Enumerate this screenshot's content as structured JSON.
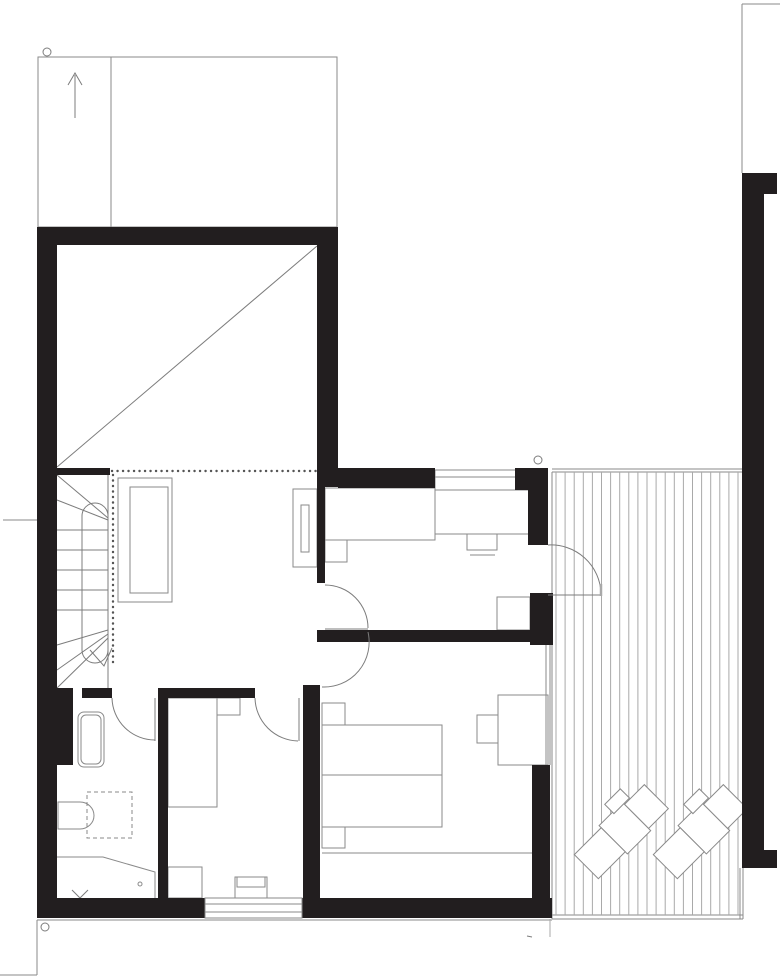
{
  "title": "upper-floor-plan",
  "palette": {
    "wall": "#221e1f",
    "line": "#8a8a8a",
    "mid": "#7c7c7c",
    "light": "#a9a9a9",
    "bg": "#ffffff"
  },
  "plan": {
    "width": 780,
    "height": 979,
    "shapes": [
      {
        "t": "rect",
        "name": "carport-outline",
        "x": 38,
        "y": 57,
        "w": 299,
        "h": 170,
        "c": "line"
      },
      {
        "t": "line",
        "name": "carport-divider",
        "x1": 111,
        "y1": 57,
        "x2": 111,
        "y2": 227,
        "c": "line"
      },
      {
        "t": "line",
        "name": "entry-arrow-shaft",
        "x1": 75,
        "y1": 118,
        "x2": 75,
        "y2": 75,
        "c": "mid"
      },
      {
        "t": "poly",
        "name": "entry-arrow-head",
        "pts": "68,85 75,73 82,85",
        "c": "mid"
      },
      {
        "t": "line",
        "name": "site-line-top-right-h",
        "x1": 742,
        "y1": 4,
        "x2": 780,
        "y2": 4,
        "c": "line"
      },
      {
        "t": "line",
        "name": "site-line-top-right-v",
        "x1": 742,
        "y1": 4,
        "x2": 742,
        "y2": 173,
        "c": "line"
      },
      {
        "t": "line",
        "name": "section-tick-left",
        "x1": 3,
        "y1": 520,
        "x2": 37,
        "y2": 520,
        "c": "line"
      },
      {
        "t": "line",
        "name": "ground-line-bottom",
        "x1": 37,
        "y1": 920,
        "x2": 552,
        "y2": 920,
        "c": "line"
      },
      {
        "t": "line",
        "name": "terrain-line-v",
        "x1": 37,
        "y1": 920,
        "x2": 37,
        "y2": 975,
        "c": "line"
      },
      {
        "t": "line",
        "name": "terrain-line-h",
        "x1": 0,
        "y1": 975,
        "x2": 37,
        "y2": 975,
        "c": "line"
      },
      {
        "t": "line",
        "name": "terrain-line-under-deck",
        "x1": 550,
        "y1": 919,
        "x2": 550,
        "y2": 937,
        "c": "light"
      },
      {
        "t": "line",
        "name": "tiny-mark",
        "x1": 527,
        "y1": 936,
        "x2": 532,
        "y2": 937,
        "c": "mid"
      },
      {
        "t": "line",
        "name": "deck-edge-top-1",
        "x1": 552,
        "y1": 469,
        "x2": 742,
        "y2": 469,
        "c": "line"
      },
      {
        "t": "line",
        "name": "deck-edge-top-2",
        "x1": 552,
        "y1": 472,
        "x2": 742,
        "y2": 472,
        "c": "line"
      },
      {
        "t": "line",
        "name": "deck-edge-left",
        "x1": 552,
        "y1": 472,
        "x2": 552,
        "y2": 919,
        "c": "line"
      },
      {
        "t": "line",
        "name": "deck-edge-bottom-1",
        "x1": 552,
        "y1": 915,
        "x2": 743,
        "y2": 915,
        "c": "line"
      },
      {
        "t": "line",
        "name": "deck-edge-bottom-2",
        "x1": 552,
        "y1": 919,
        "x2": 743,
        "y2": 919,
        "c": "line"
      },
      {
        "t": "line",
        "name": "deck-edge-right-1",
        "x1": 740,
        "y1": 868,
        "x2": 740,
        "y2": 919,
        "c": "line"
      },
      {
        "t": "line",
        "name": "deck-edge-right-2",
        "x1": 743,
        "y1": 868,
        "x2": 743,
        "y2": 919,
        "c": "line"
      },
      {
        "t": "vlines",
        "name": "deck-boards",
        "from": 556,
        "to": 738,
        "step": 9.1,
        "y1": 472,
        "y2": 915,
        "c": "light"
      },
      {
        "t": "group",
        "name": "sun-lounger-1",
        "tx": 621,
        "ty": 832,
        "rot": 45,
        "shapes": [
          {
            "t": "rect",
            "name": "lounger-head",
            "x": -17,
            "y": -50,
            "w": 34,
            "h": 28,
            "c": "line",
            "f": "#ffffff"
          },
          {
            "t": "rect",
            "name": "lounger-seat",
            "x": -20,
            "y": -22,
            "w": 40,
            "h": 33,
            "c": "line",
            "f": "#ffffff"
          },
          {
            "t": "rect",
            "name": "lounger-foot",
            "x": -17,
            "y": 11,
            "w": 34,
            "h": 38,
            "c": "line",
            "f": "#ffffff"
          },
          {
            "t": "rect",
            "name": "lounger-side-table",
            "x": -31,
            "y": -30,
            "w": 13,
            "h": 22,
            "c": "line",
            "f": "#ffffff"
          }
        ]
      },
      {
        "t": "group",
        "name": "sun-lounger-2",
        "tx": 700,
        "ty": 832,
        "rot": 45,
        "shapes": [
          {
            "t": "rect",
            "name": "lounger-head",
            "x": -17,
            "y": -50,
            "w": 34,
            "h": 28,
            "c": "line",
            "f": "#ffffff"
          },
          {
            "t": "rect",
            "name": "lounger-seat",
            "x": -20,
            "y": -22,
            "w": 40,
            "h": 33,
            "c": "line",
            "f": "#ffffff"
          },
          {
            "t": "rect",
            "name": "lounger-foot",
            "x": -17,
            "y": 11,
            "w": 34,
            "h": 38,
            "c": "line",
            "f": "#ffffff"
          },
          {
            "t": "rect",
            "name": "lounger-side-table",
            "x": -31,
            "y": -30,
            "w": 13,
            "h": 22,
            "c": "line",
            "f": "#ffffff"
          }
        ]
      },
      {
        "t": "line",
        "name": "void-diagonal",
        "x1": 57,
        "y1": 467,
        "x2": 317,
        "y2": 246,
        "c": "mid"
      },
      {
        "t": "rect",
        "name": "hall-sideboard-outer",
        "x": 118,
        "y": 478,
        "w": 54,
        "h": 124,
        "c": "line"
      },
      {
        "t": "rect",
        "name": "hall-sideboard-inner",
        "x": 130,
        "y": 487,
        "w": 38,
        "h": 106,
        "c": "line"
      },
      {
        "t": "rect",
        "name": "hall-cabinet",
        "x": 293,
        "y": 489,
        "w": 24,
        "h": 78,
        "c": "line"
      },
      {
        "t": "rect",
        "name": "hall-cabinet-inner",
        "x": 301,
        "y": 505,
        "w": 8,
        "h": 47,
        "c": "line"
      },
      {
        "t": "hlines",
        "name": "stair-treads",
        "ys": [
          530,
          550,
          570,
          590,
          610
        ],
        "x1": 57,
        "x2": 108,
        "c": "mid"
      },
      {
        "t": "line",
        "name": "stair-edge-right",
        "x1": 108,
        "y1": 475,
        "x2": 108,
        "y2": 688,
        "c": "mid"
      },
      {
        "t": "line",
        "name": "stair-winder-t1",
        "x1": 108,
        "y1": 518,
        "x2": 57,
        "y2": 475,
        "c": "mid"
      },
      {
        "t": "line",
        "name": "stair-winder-t2",
        "x1": 108,
        "y1": 520,
        "x2": 57,
        "y2": 500,
        "c": "mid"
      },
      {
        "t": "line",
        "name": "stair-winder-b1",
        "x1": 108,
        "y1": 630,
        "x2": 57,
        "y2": 645,
        "c": "mid"
      },
      {
        "t": "line",
        "name": "stair-winder-b2",
        "x1": 108,
        "y1": 634,
        "x2": 57,
        "y2": 670,
        "c": "mid"
      },
      {
        "t": "line",
        "name": "stair-winder-b3",
        "x1": 108,
        "y1": 638,
        "x2": 57,
        "y2": 688,
        "c": "mid"
      },
      {
        "t": "rect",
        "name": "stair-walkline",
        "x": 82,
        "y": 503,
        "w": 26,
        "h": 160,
        "rx": 13,
        "c": "mid"
      },
      {
        "t": "poly",
        "name": "stair-walkline-arrow",
        "pts": "90,650 104,666 112,648",
        "c": "mid"
      },
      {
        "t": "dot",
        "name": "balustrade-horizontal",
        "x1": 112,
        "y1": 471,
        "x2": 317,
        "y2": 471
      },
      {
        "t": "dot",
        "name": "balustrade-vertical",
        "x1": 113,
        "y1": 475,
        "x2": 113,
        "y2": 665
      },
      {
        "t": "rect",
        "name": "bedroom1-wardrobe",
        "x": 435,
        "y": 470,
        "w": 82,
        "h": 20,
        "c": "line"
      },
      {
        "t": "line",
        "name": "bedroom1-wardrobe-line",
        "x1": 435,
        "y1": 477,
        "x2": 517,
        "y2": 477,
        "c": "line"
      },
      {
        "t": "rect",
        "name": "bedroom1-bed",
        "x": 325,
        "y": 488,
        "w": 110,
        "h": 52,
        "c": "line"
      },
      {
        "t": "rect",
        "name": "bedroom1-nightstand",
        "x": 325,
        "y": 540,
        "w": 22,
        "h": 22,
        "c": "line"
      },
      {
        "t": "rect",
        "name": "bedroom1-desk",
        "x": 435,
        "y": 490,
        "w": 95,
        "h": 44,
        "c": "line"
      },
      {
        "t": "rect",
        "name": "bedroom1-chair",
        "x": 467,
        "y": 534,
        "w": 30,
        "h": 16,
        "c": "line"
      },
      {
        "t": "line",
        "name": "bedroom1-chair-front",
        "x1": 470,
        "y1": 555,
        "x2": 495,
        "y2": 555,
        "c": "line"
      },
      {
        "t": "rect",
        "name": "bedroom1-cabinet",
        "x": 497,
        "y": 597,
        "w": 33,
        "h": 33,
        "c": "line"
      },
      {
        "t": "rect",
        "name": "bedroom3-nightstand-a",
        "x": 322,
        "y": 703,
        "w": 23,
        "h": 22,
        "c": "line"
      },
      {
        "t": "rect",
        "name": "bedroom3-bed",
        "x": 322,
        "y": 725,
        "w": 120,
        "h": 102,
        "c": "line"
      },
      {
        "t": "line",
        "name": "bedroom3-bed-midline",
        "x1": 322,
        "y1": 775,
        "x2": 442,
        "y2": 775,
        "c": "line"
      },
      {
        "t": "rect",
        "name": "bedroom3-nightstand-b",
        "x": 322,
        "y": 827,
        "w": 23,
        "h": 21,
        "c": "line"
      },
      {
        "t": "line",
        "name": "bedroom3-bench-line",
        "x1": 322,
        "y1": 853,
        "x2": 533,
        "y2": 853,
        "c": "line"
      },
      {
        "t": "rect",
        "name": "bedroom3-desk",
        "x": 498,
        "y": 695,
        "w": 50,
        "h": 70,
        "c": "line"
      },
      {
        "t": "rect",
        "name": "bedroom3-chair",
        "x": 477,
        "y": 715,
        "w": 21,
        "h": 28,
        "c": "line"
      },
      {
        "t": "line",
        "name": "east-window-glazing-1",
        "x1": 546,
        "y1": 645,
        "x2": 546,
        "y2": 765,
        "c": "line"
      },
      {
        "t": "line",
        "name": "east-window-glazing-2",
        "x1": 550,
        "y1": 645,
        "x2": 550,
        "y2": 765,
        "c": "line"
      },
      {
        "t": "rect",
        "name": "bedroom2-bed",
        "x": 168,
        "y": 698,
        "w": 49,
        "h": 109,
        "c": "line"
      },
      {
        "t": "rect",
        "name": "bedroom2-nightstand",
        "x": 217,
        "y": 698,
        "w": 23,
        "h": 17,
        "c": "line"
      },
      {
        "t": "rect",
        "name": "bedroom2-dresser-a",
        "x": 168,
        "y": 867,
        "w": 34,
        "h": 31,
        "c": "line"
      },
      {
        "t": "rect",
        "name": "bedroom2-dresser-b",
        "x": 235,
        "y": 877,
        "w": 32,
        "h": 21,
        "c": "line"
      },
      {
        "t": "rect",
        "name": "bedroom2-dresser-b-inner",
        "x": 237,
        "y": 877,
        "w": 28,
        "h": 10,
        "c": "line"
      },
      {
        "t": "rect",
        "name": "bathtub-outer",
        "x": 78,
        "y": 712,
        "w": 26,
        "h": 55,
        "rx": 6,
        "c": "line"
      },
      {
        "t": "rect",
        "name": "bathtub-inner",
        "x": 81,
        "y": 715,
        "w": 20,
        "h": 49,
        "rx": 5,
        "c": "line"
      },
      {
        "t": "path",
        "name": "toilet",
        "d": "M80 802 L58 802 L58 829 L80 829 A14 13.5 0 0 0 80 802 Z",
        "c": "line",
        "f": "#ffffff"
      },
      {
        "t": "rect",
        "name": "shower-dashed",
        "x": 87,
        "y": 792,
        "w": 45,
        "h": 46,
        "c": "line",
        "dash": "4 3"
      },
      {
        "t": "poly",
        "name": "vanity-counter",
        "pts": "57,857 103,857 155,872 155,898",
        "c": "line"
      },
      {
        "t": "poly",
        "name": "vanity-check-mark",
        "pts": "72,890 80,898 88,890",
        "c": "mid"
      },
      {
        "t": "circle",
        "name": "drain-dot",
        "cx": 140,
        "cy": 884,
        "r": 2,
        "c": "line"
      },
      {
        "t": "wall",
        "name": "wall-void-top",
        "x": 37,
        "y": 227,
        "w": 301,
        "h": 18
      },
      {
        "t": "wall",
        "name": "wall-exterior-left",
        "x": 37,
        "y": 227,
        "w": 20,
        "h": 691
      },
      {
        "t": "wall",
        "name": "wall-void-right",
        "x": 317,
        "y": 227,
        "w": 21,
        "h": 260
      },
      {
        "t": "wall",
        "name": "wall-void-south-stub",
        "x": 55,
        "y": 468,
        "w": 55,
        "h": 7
      },
      {
        "t": "wall",
        "name": "wall-bedroom1-top",
        "x": 338,
        "y": 468,
        "w": 97,
        "h": 20
      },
      {
        "t": "wall",
        "name": "wall-pier-top-a",
        "x": 515,
        "y": 468,
        "w": 33,
        "h": 22
      },
      {
        "t": "wall",
        "name": "wall-pier-top-b",
        "x": 528,
        "y": 490,
        "w": 20,
        "h": 55
      },
      {
        "t": "wall",
        "name": "wall-hall-thin",
        "x": 317,
        "y": 487,
        "w": 8,
        "h": 96
      },
      {
        "t": "wall",
        "name": "wall-mid-horizontal",
        "x": 317,
        "y": 630,
        "w": 213,
        "h": 12
      },
      {
        "t": "wall",
        "name": "wall-pier-mid",
        "x": 530,
        "y": 593,
        "w": 23,
        "h": 52
      },
      {
        "t": "wall",
        "name": "wall-exterior-right-bottom",
        "x": 532,
        "y": 765,
        "w": 18,
        "h": 153
      },
      {
        "t": "wall",
        "name": "wall-bottom-a",
        "x": 37,
        "y": 898,
        "w": 168,
        "h": 20
      },
      {
        "t": "wall",
        "name": "wall-bottom-b",
        "x": 302,
        "y": 898,
        "w": 250,
        "h": 20
      },
      {
        "t": "wall",
        "name": "wall-center-vertical",
        "x": 303,
        "y": 685,
        "w": 17,
        "h": 213
      },
      {
        "t": "wall",
        "name": "wall-bath-bed2",
        "x": 158,
        "y": 688,
        "w": 10,
        "h": 210
      },
      {
        "t": "wall",
        "name": "wall-bath-top-seg",
        "x": 82,
        "y": 688,
        "w": 30,
        "h": 10
      },
      {
        "t": "wall",
        "name": "wall-bath-stub",
        "x": 55,
        "y": 688,
        "w": 18,
        "h": 77
      },
      {
        "t": "wall",
        "name": "wall-bedroom2-top",
        "x": 168,
        "y": 688,
        "w": 87,
        "h": 10
      },
      {
        "t": "wall",
        "name": "wall-ne-flange",
        "x": 742,
        "y": 173,
        "w": 35,
        "h": 21
      },
      {
        "t": "wall",
        "name": "wall-ne-vertical",
        "x": 742,
        "y": 194,
        "w": 22,
        "h": 674
      },
      {
        "t": "wall",
        "name": "wall-ne-foot",
        "x": 764,
        "y": 850,
        "w": 13,
        "h": 18
      },
      {
        "t": "rect",
        "name": "window-bottom",
        "x": 205,
        "y": 898,
        "w": 97,
        "h": 20,
        "c": "line",
        "f": "#ffffff"
      },
      {
        "t": "line",
        "name": "window-bottom-line-1",
        "x1": 205,
        "y1": 904,
        "x2": 302,
        "y2": 904,
        "c": "line"
      },
      {
        "t": "line",
        "name": "window-bottom-line-2",
        "x1": 205,
        "y1": 912,
        "x2": 302,
        "y2": 912,
        "c": "line"
      },
      {
        "t": "path",
        "name": "door-arc-bathroom",
        "d": "M112 698 A43 43 0 0 0 155 740",
        "c": "mid"
      },
      {
        "t": "line",
        "name": "door-leaf-bathroom",
        "x1": 155,
        "y1": 698,
        "x2": 155,
        "y2": 741,
        "c": "mid"
      },
      {
        "t": "path",
        "name": "door-arc-bedroom2",
        "d": "M255 698 A44 44 0 0 0 298 741",
        "c": "mid"
      },
      {
        "t": "line",
        "name": "door-leaf-bedroom2",
        "x1": 299,
        "y1": 698,
        "x2": 299,
        "y2": 741,
        "c": "mid"
      },
      {
        "t": "path",
        "name": "door-arc-bedroom1",
        "d": "M368 628 A43 43 0 0 0 325 585",
        "c": "mid"
      },
      {
        "t": "line",
        "name": "door-leaf-bedroom1",
        "x1": 325,
        "y1": 629,
        "x2": 368,
        "y2": 629,
        "c": "mid"
      },
      {
        "t": "path",
        "name": "door-arc-bedroom3",
        "d": "M368 632 A45 45 0 0 1 322 687",
        "c": "mid"
      },
      {
        "t": "path",
        "name": "door-arc-deck",
        "d": "M548 545 A50 50 0 0 1 601 593",
        "c": "mid"
      },
      {
        "t": "line",
        "name": "door-leaf-deck",
        "x1": 548,
        "y1": 595,
        "x2": 602,
        "y2": 595,
        "c": "mid"
      },
      {
        "t": "line",
        "name": "door-leaf-deck-tick",
        "x1": 601,
        "y1": 584,
        "x2": 601,
        "y2": 596,
        "c": "light",
        "w": 2.5
      },
      {
        "t": "circle",
        "name": "section-marker-top-left",
        "cx": 47,
        "cy": 52,
        "r": 4,
        "c": "mid"
      },
      {
        "t": "circle",
        "name": "section-marker-deck",
        "cx": 538,
        "cy": 460,
        "r": 4,
        "c": "mid"
      },
      {
        "t": "circle",
        "name": "section-marker-bottom-left",
        "cx": 45,
        "cy": 927,
        "r": 4,
        "c": "mid"
      }
    ]
  }
}
